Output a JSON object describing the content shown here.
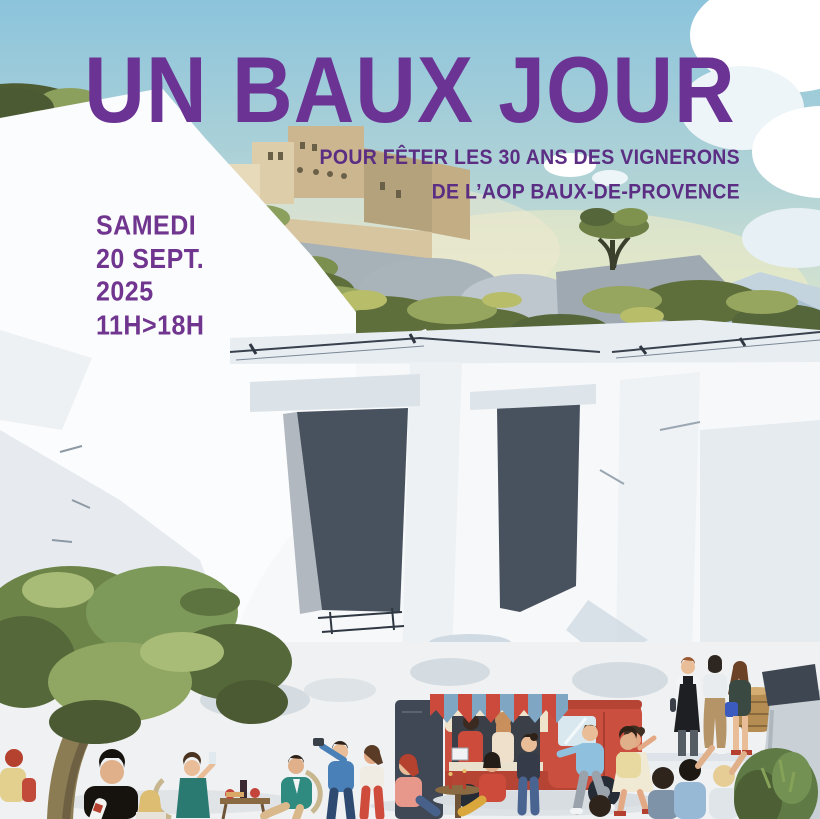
{
  "poster": {
    "title": "UN BAUX JOUR",
    "subtitle_line1": "POUR FÊTER LES 30 ANS DES VIGNERONS",
    "subtitle_line2": "DE L’AOP BAUX-DE-PROVENCE",
    "date_day": "SAMEDI",
    "date_date": "20 SEPT.",
    "date_year": "2025",
    "date_hours": "11H>18H",
    "colors": {
      "title_purple": "#6b3494",
      "subtitle_purple": "#5b2d83",
      "date_purple": "#70368f",
      "sky_blue": "#8cc4dc",
      "quarry_white": "#f6f8fa",
      "quarry_opening_dark": "#48515e",
      "village_tan": "#d8c6a2",
      "olive_green": "#6d8449",
      "truck_red": "#cb4f3e",
      "awning_blue": "#7fa6c3"
    }
  }
}
